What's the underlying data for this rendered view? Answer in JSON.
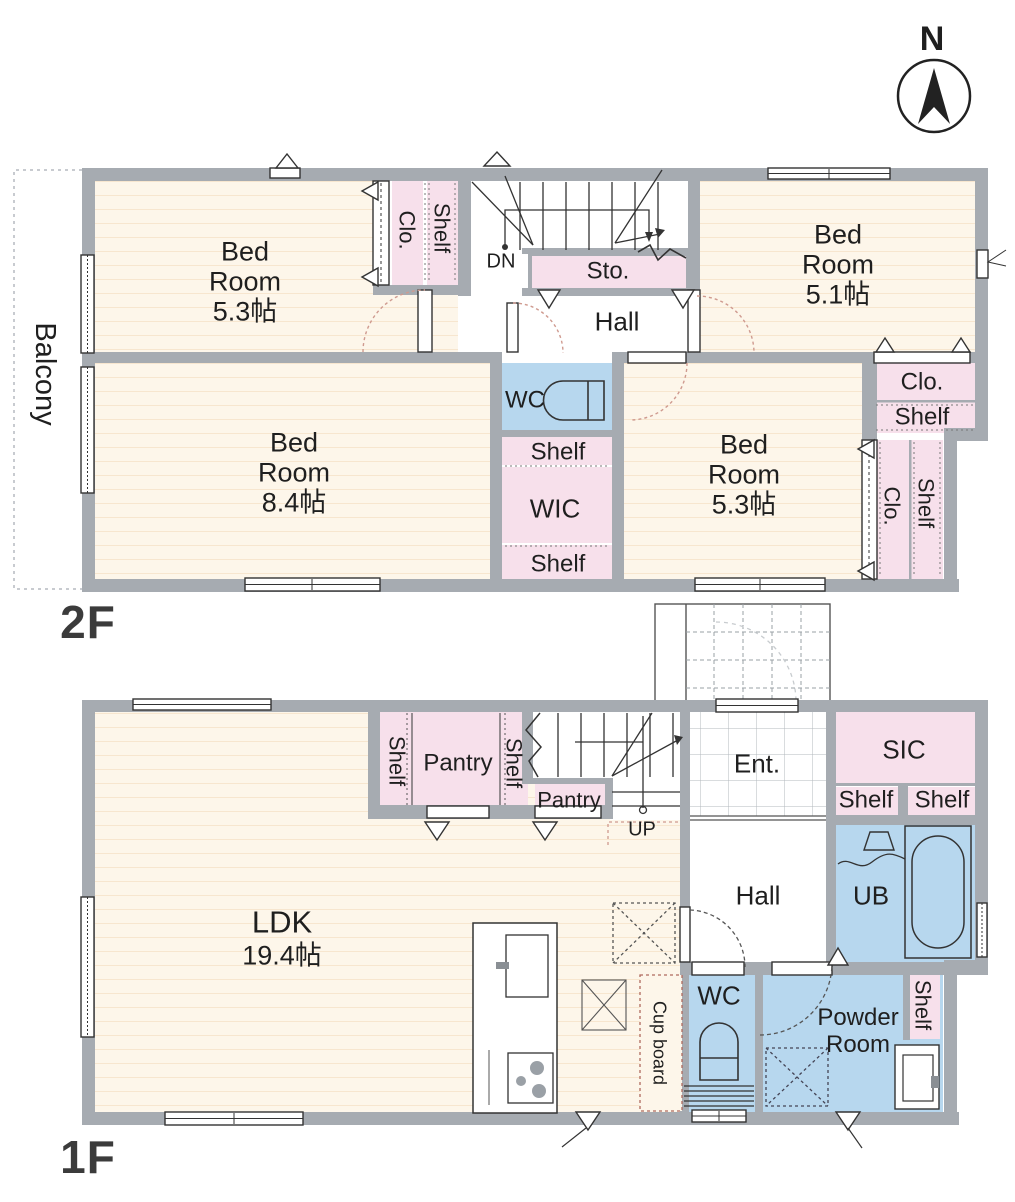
{
  "colors": {
    "wall_gray": "#a6abb1",
    "floor_cream": "#fdf6ea",
    "floor_stripe": "#f7e6cf",
    "closet_pink": "#f7e0eb",
    "water_blue": "#b7d7ee",
    "door_arc_red": "#cf9a8f"
  },
  "compass": {
    "label": "N"
  },
  "floor2": {
    "floor_label": "2F",
    "balcony_label": "Balcony",
    "bedroom_nw": {
      "name": "Bed Room",
      "size": "5.3帖"
    },
    "closet_nw_label": "Clo.",
    "shelf_nw_label": "Shelf",
    "stairs_down_label": "DN",
    "storage_label": "Sto.",
    "hall_label": "Hall",
    "bedroom_ne": {
      "name": "Bed Room",
      "size": "5.1帖"
    },
    "closet_ne_label": "Clo.",
    "shelf_ne_label": "Shelf",
    "wc_label": "WC",
    "shelf_above_wic_label": "Shelf",
    "wic_label": "WIC",
    "shelf_below_wic_label": "Shelf",
    "bedroom_sw": {
      "name": "Bed Room",
      "size": "8.4帖"
    },
    "bedroom_se": {
      "name": "Bed Room",
      "size": "5.3帖"
    },
    "closet_se_label": "Clo.",
    "shelf_se_label": "Shelf"
  },
  "floor1": {
    "floor_label": "1F",
    "ldk": {
      "name": "LDK",
      "size": "19.4帖"
    },
    "shelf_pantry_left_label": "Shelf",
    "pantry_label": "Pantry",
    "shelf_pantry_right_label": "Shelf",
    "pantry_under_stairs_label": "Pantry",
    "stairs_up_label": "UP",
    "entrance_label": "Ent.",
    "sic_label": "SIC",
    "sic_shelf_left_label": "Shelf",
    "sic_shelf_right_label": "Shelf",
    "hall_label": "Hall",
    "unit_bath_label": "UB",
    "wc_label": "WC",
    "powder_room_label": "Powder Room",
    "powder_shelf_label": "Shelf",
    "cupboard_label": "Cup board"
  }
}
